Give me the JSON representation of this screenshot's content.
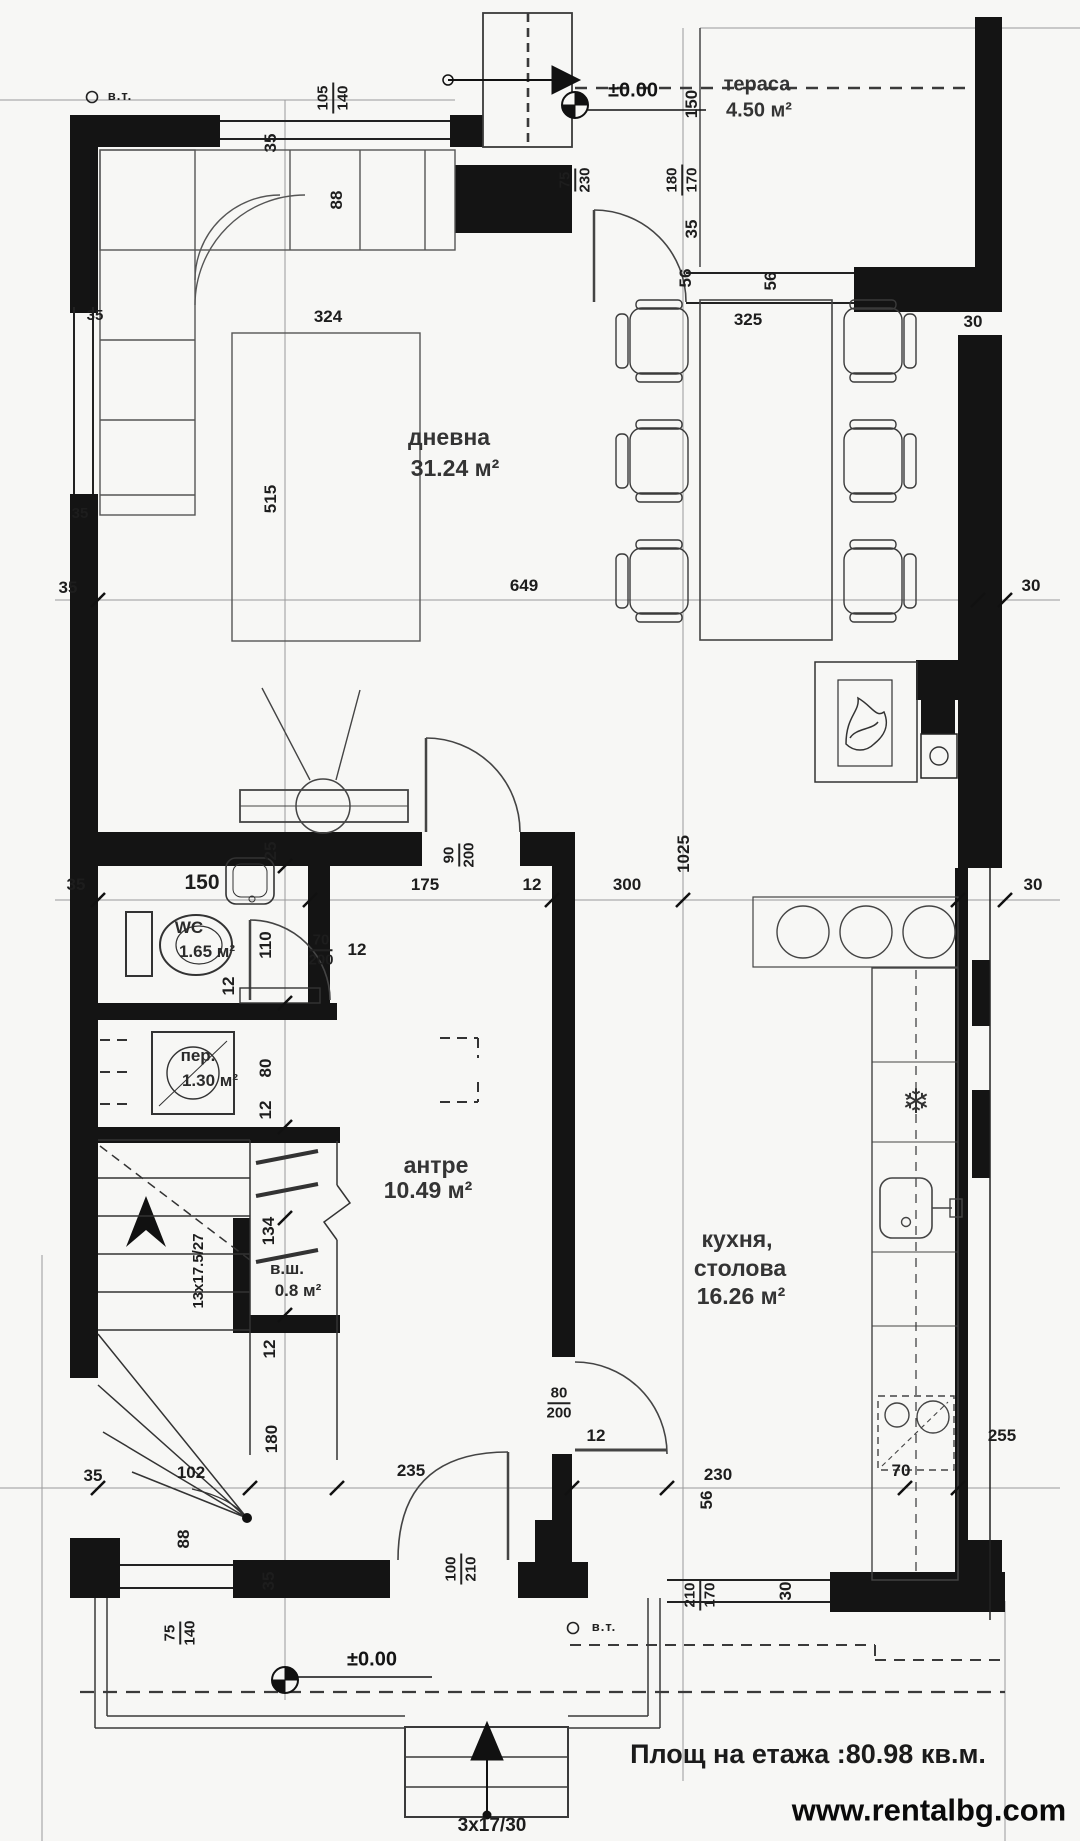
{
  "watermark": "www.rentalbg.com",
  "footer": {
    "floor_area": "Площ на етажа :80.98 кв.м."
  },
  "markers": {
    "vt": "в.т.",
    "elevation": "±0.00"
  },
  "icons": {
    "fridge": "❄"
  },
  "rooms": {
    "terrace": {
      "name": "тераса",
      "area": "4.50 м²"
    },
    "living": {
      "name": "дневна",
      "area": "31.24 м²"
    },
    "hall": {
      "name": "антре",
      "area": "10.49 м²"
    },
    "kitchen": {
      "name_line1": "кухня,",
      "name_line2": "столова",
      "area": "16.26 м²"
    },
    "wc": {
      "name": "WC",
      "area": "1.65 м²"
    },
    "laundry": {
      "name": "пер.",
      "area": "1.30 м²"
    },
    "closet": {
      "name": "в.ш.",
      "area": "0.8 м²"
    }
  },
  "stairs": {
    "main": "13x17.5/27",
    "entry": "3x17/30"
  },
  "dims": {
    "d12": "12",
    "d25": "25",
    "d30": "30",
    "d35": "35",
    "d56": "56",
    "d70": "70",
    "d75": "75",
    "d80": "80",
    "d88": "88",
    "d90": "90",
    "d100": "100",
    "d102": "102",
    "d105": "105",
    "d110": "110",
    "d134": "134",
    "d140": "140",
    "d150": "150",
    "d170": "170",
    "d175": "175",
    "d180": "180",
    "d200": "200",
    "d210": "210",
    "d230": "230",
    "d235": "235",
    "d255": "255",
    "d300": "300",
    "d324": "324",
    "d325": "325",
    "d515": "515",
    "d649": "649",
    "d1025": "1025"
  }
}
